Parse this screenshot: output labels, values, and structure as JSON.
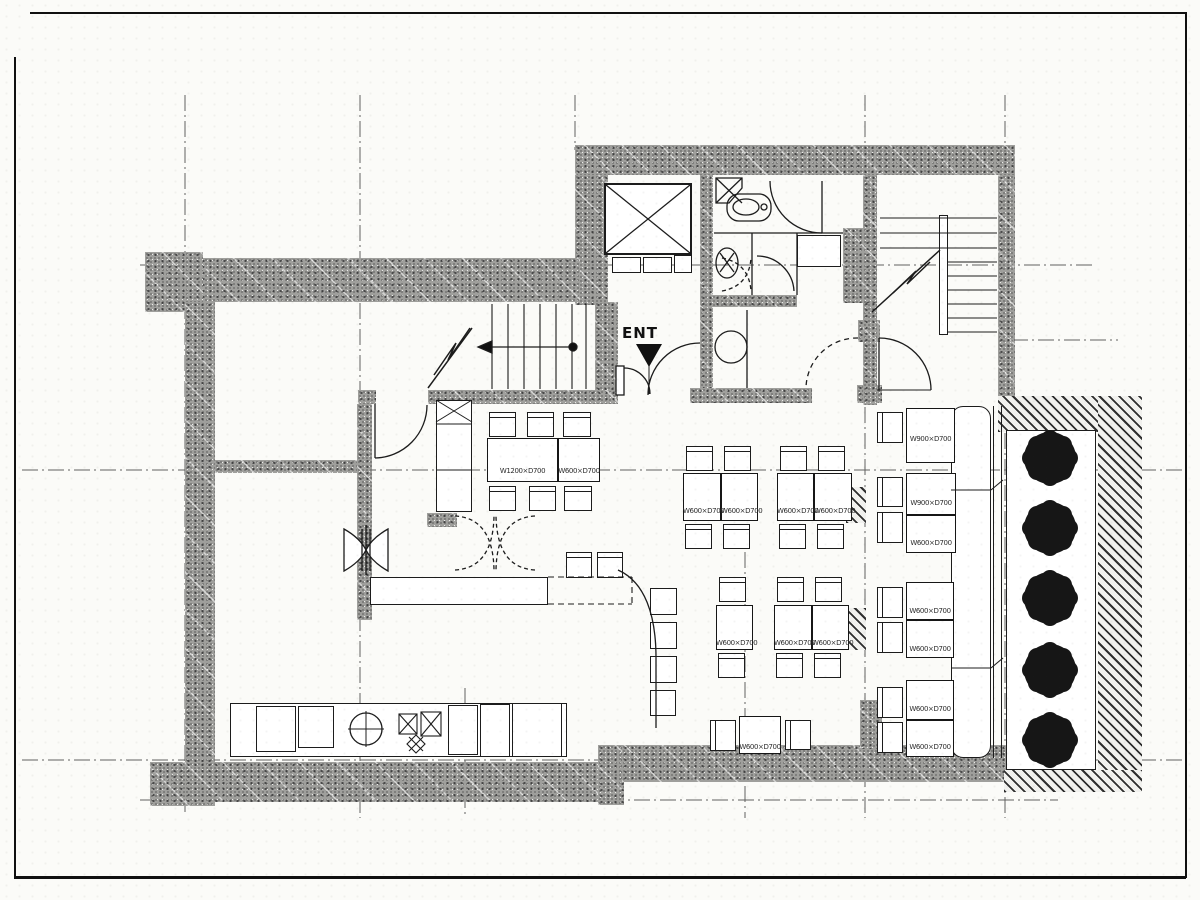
{
  "colors": {
    "paper": "#fbfbf8",
    "ink": "#1c1c1c",
    "wall_gray": "#9f9f9c"
  },
  "entrance": {
    "label": "ENT"
  },
  "tables": [
    {
      "id": "a1",
      "label": "W1200×D700"
    },
    {
      "id": "a2",
      "label": "W600×D700"
    },
    {
      "id": "b1",
      "label": "W600×D700"
    },
    {
      "id": "b2",
      "label": "W600×D700"
    },
    {
      "id": "b3",
      "label": "W600×D700"
    },
    {
      "id": "b4",
      "label": "W600×D700"
    },
    {
      "id": "c1",
      "label": "W600×D700"
    },
    {
      "id": "c2",
      "label": "W600×D700"
    },
    {
      "id": "c3",
      "label": "W600×D700"
    },
    {
      "id": "d1",
      "label": "W600×D700"
    },
    {
      "id": "e1",
      "label": "W900×D700"
    },
    {
      "id": "e2",
      "label": "W900×D700"
    },
    {
      "id": "e3",
      "label": "W600×D700"
    },
    {
      "id": "e4",
      "label": "W600×D700"
    },
    {
      "id": "e5",
      "label": "W600×D700"
    },
    {
      "id": "e6",
      "label": "W600×D700"
    },
    {
      "id": "e7",
      "label": "W600×D700"
    }
  ]
}
